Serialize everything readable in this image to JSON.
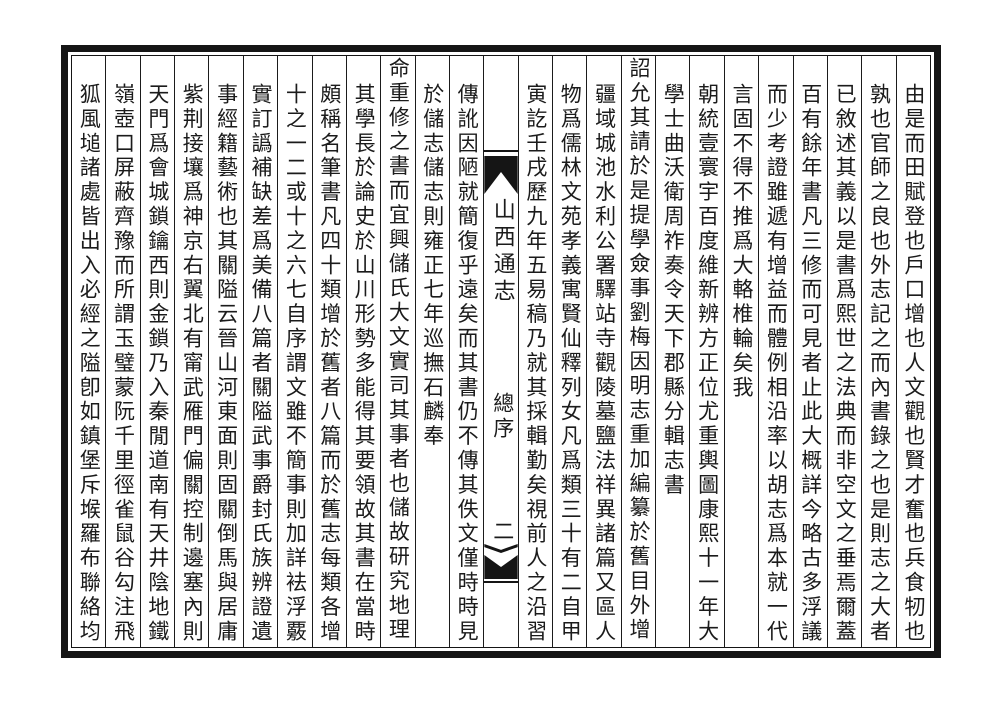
{
  "book": {
    "title": "山西通志",
    "section": "總序",
    "page_number": "二"
  },
  "colors": {
    "ink": "#1b1b1b",
    "paper": "#ffffff",
    "frame": "#151515"
  },
  "columns": [
    {
      "text": "由是而田賦登也戶口增也人文觀也賢才奮也兵食牣也",
      "elevated": false
    },
    {
      "text": "孰也官師之良也外志記之而內書錄之也是則志之大者",
      "elevated": false
    },
    {
      "text": "已敘述其義以是書爲熙世之法典而非空文之垂焉爾蓋",
      "elevated": false
    },
    {
      "text": "百有餘年書凡三修而可見者止此大概詳今略古多浮議",
      "elevated": false
    },
    {
      "text": "而少考證雖遞有增益而體例相沿率以胡志爲本就一代",
      "elevated": false
    },
    {
      "text": "言固不得不推爲大輅椎輪矣我",
      "elevated": false
    },
    {
      "text": "朝統壹寰宇百度維新辨方正位尤重輿圖康熙十一年大",
      "elevated": false
    },
    {
      "text": "學士曲沃衛周祚奏令天下郡縣分輯志書",
      "elevated": false
    },
    {
      "text": "詔允其請於是提學僉事劉梅因明志重加編纂於舊目外增",
      "elevated": true
    },
    {
      "text": "疆域城池水利公署驛站寺觀陵墓鹽法祥異諸篇又區人",
      "elevated": false
    },
    {
      "text": "物爲儒林文苑孝義寓賢仙釋列女凡爲類三十有二自甲",
      "elevated": false
    },
    {
      "text": "寅訖壬戌歷九年五易稿乃就其採輯勤矣視前人之沿習",
      "elevated": false
    },
    {
      "text": "傳訛因陋就簡復乎遠矣而其書仍不傳其佚文僅時時見",
      "elevated": false
    },
    {
      "text": "於儲志儲志則雍正七年巡撫石麟奉",
      "elevated": false
    },
    {
      "text": "命重修之書而宜興儲氏大文實司其事者也儲故研究地理",
      "elevated": true
    },
    {
      "text": "其學長於論史於山川形勢多能得其要領故其書在當時",
      "elevated": false
    },
    {
      "text": "頗稱名筆書凡四十類增於舊者八篇而於舊志每類各增",
      "elevated": false
    },
    {
      "text": "十之一二或十之六七自序謂文雖不簡事則加詳袪浮覈",
      "elevated": false
    },
    {
      "text": "實訂譌補缺差爲美備八篇者關隘武事爵封氏族辨證遺",
      "elevated": false
    },
    {
      "text": "事經籍藝術也其關隘云晉山河東面則固關倒馬與居庸",
      "elevated": false
    },
    {
      "text": "紫荆接壤爲神京右翼北有甯武雁門偏關控制邊塞內則",
      "elevated": false
    },
    {
      "text": "天門爲會城鎖鑰西則金鎖乃入秦閒道南有天井陰地鐵",
      "elevated": false
    },
    {
      "text": "嶺壺口屏蔽齊豫而所謂玉璧蒙阮千里徑雀鼠谷勾注飛",
      "elevated": false
    },
    {
      "text": "狐風塠諸處皆出入必經之隘卽如鎮堡斥堠羅布聯絡均",
      "elevated": false
    }
  ]
}
